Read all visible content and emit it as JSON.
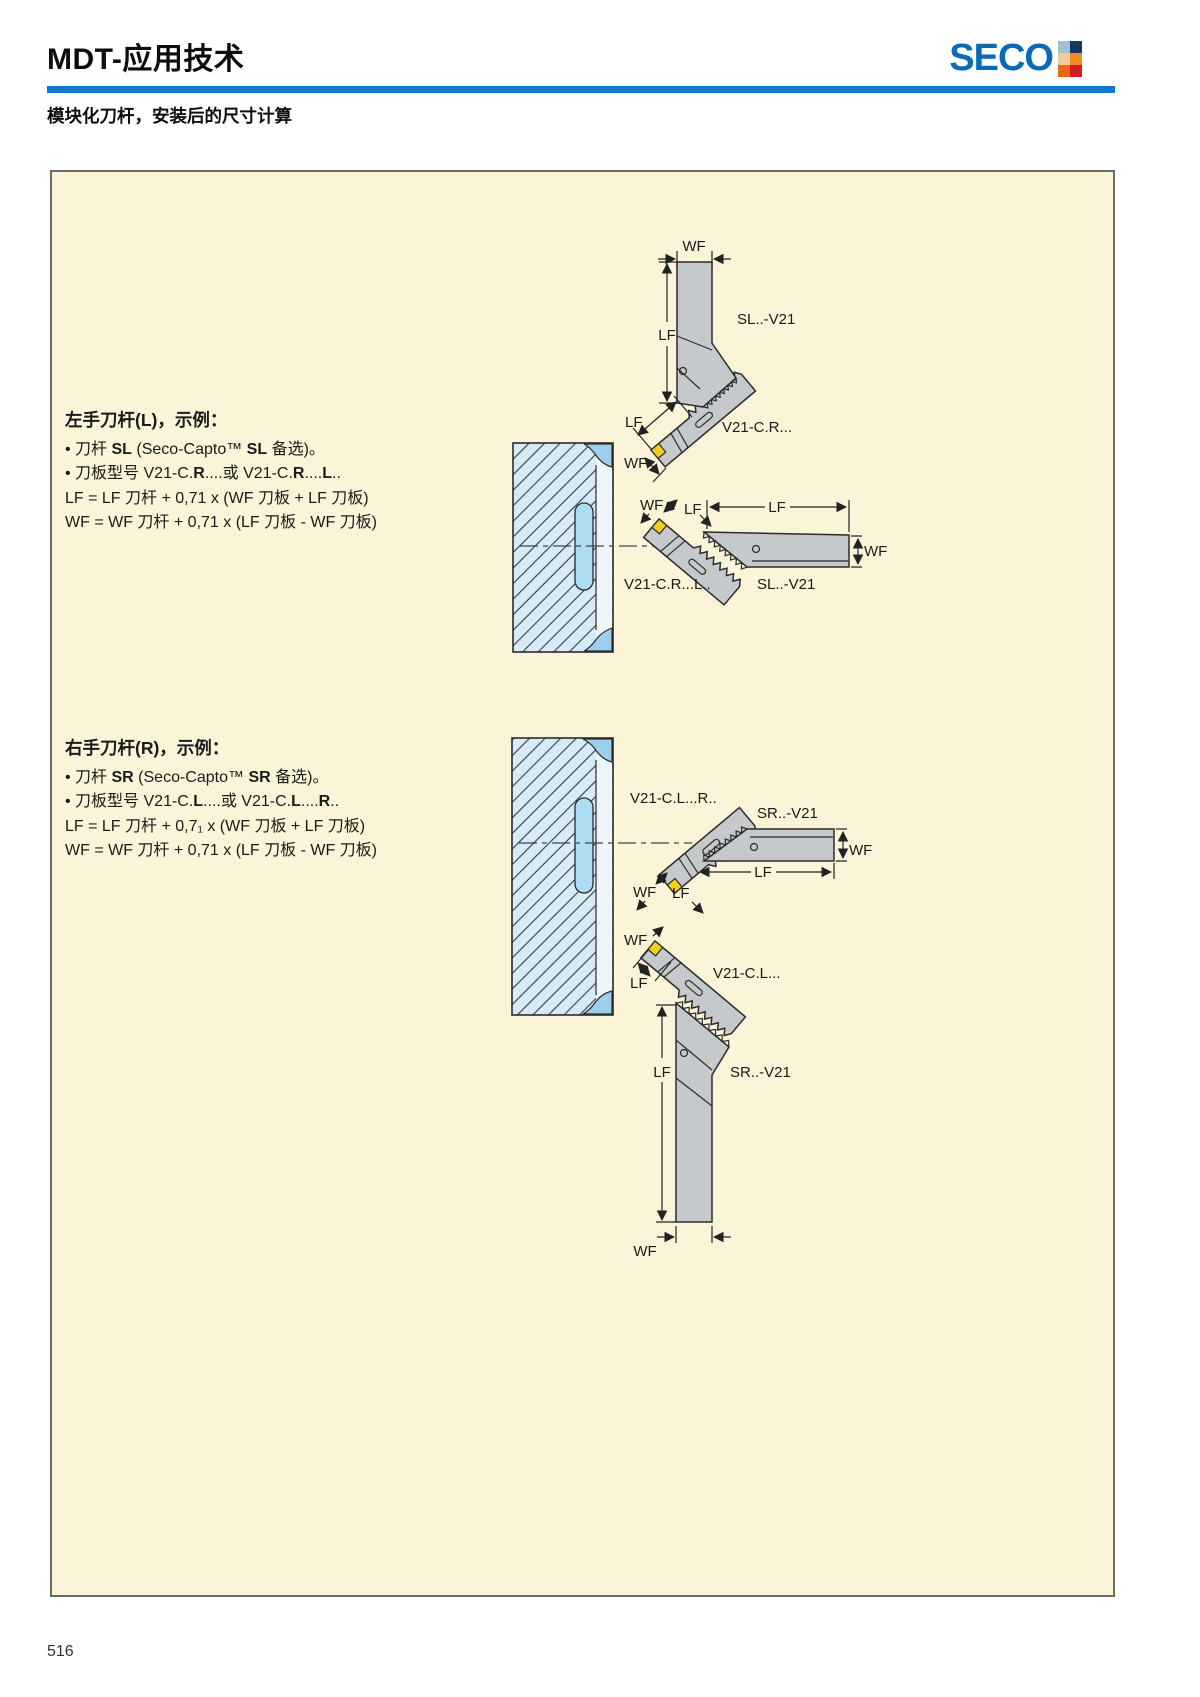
{
  "header": {
    "title": "MDT-应用技术",
    "logo": {
      "text": "SECO",
      "squares": [
        "#a9bfce",
        "#15375e",
        "#f4cba1",
        "#f08b1e",
        "#ec6718",
        "#d71920"
      ]
    }
  },
  "subtitle": "模块化刀杆，安装后的尺寸计算",
  "page_number": "516",
  "sections": {
    "left": {
      "title": "左手刀杆(L)，示例：",
      "b1": {
        "pre": "• 刀杆 ",
        "bold1": "SL",
        "mid": " (Seco-Capto™ ",
        "bold2": "SL",
        "post": " 备选)。"
      },
      "b2": {
        "pre": "• 刀板型号 V21-C.",
        "bold1": "R",
        "mid1": "....或 V21-C.",
        "bold2": "R",
        "mid2": "....",
        "bold3": "L",
        "post": ".."
      },
      "f1": "LF = LF 刀杆 + 0,71 x (WF 刀板 + LF 刀板)",
      "f2": "WF = WF 刀杆 + 0,71 x (LF 刀板 - WF 刀板)"
    },
    "right": {
      "title": "右手刀杆(R)，示例：",
      "b1": {
        "pre": "• 刀杆 ",
        "bold1": "SR",
        "mid": " (Seco-Capto™ ",
        "bold2": "SR",
        "post": " 备选)。"
      },
      "b2": {
        "pre": "• 刀板型号 V21-C.",
        "bold1": "L",
        "mid1": "....或 V21-C.",
        "bold2": "L",
        "mid2": "....",
        "bold3": "R",
        "post": ".."
      },
      "f1": "LF = LF 刀杆 + 0,7₁ x (WF 刀板 + LF 刀板)",
      "f2": "WF = WF 刀杆 + 0,71 x (LF 刀板 - WF 刀板)"
    }
  },
  "diagram": {
    "dim": {
      "wf": "WF",
      "lf": "LF"
    },
    "parts": {
      "sl": "SL..-V21",
      "sr": "SR..-V21",
      "blade_cr": "V21-C.R...",
      "blade_crl": "V21-C.R...L..",
      "blade_clr": "V21-C.L...R..",
      "blade_cl": "V21-C.L..."
    }
  }
}
